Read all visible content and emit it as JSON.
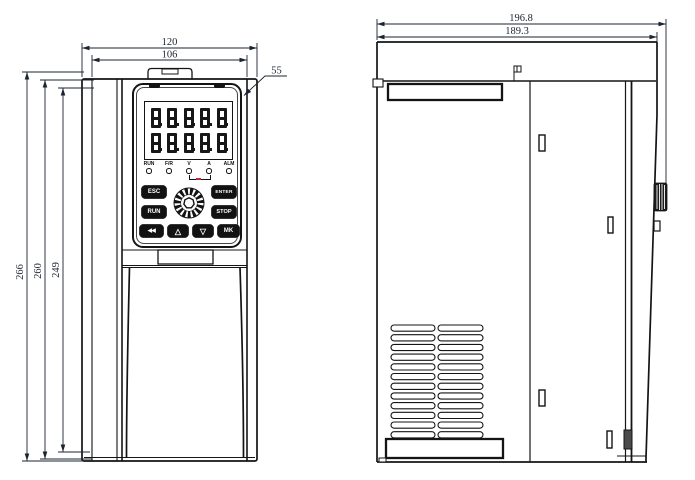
{
  "drawing": {
    "front_view": {
      "dims": {
        "width_outer": "120",
        "width_inner": "106",
        "corner_offset": "55",
        "height_outer": "266",
        "height_mid": "260",
        "height_inner": "249"
      },
      "keypad": {
        "display_row1": "8.8.8.8.8.",
        "display_row2": "8.8.8.8.8.",
        "leds": [
          "RUN",
          "F/R",
          "V",
          "A",
          "ALM"
        ],
        "buttons": {
          "esc": "ESC",
          "enter": "ENTER",
          "run": "RUN",
          "stop": "STOP",
          "shift": "◀◀",
          "up": "△",
          "down": "▽",
          "mk": "MK"
        }
      }
    },
    "side_view": {
      "dims": {
        "depth_outer": "196.8",
        "depth_inner": "189.3"
      }
    }
  }
}
